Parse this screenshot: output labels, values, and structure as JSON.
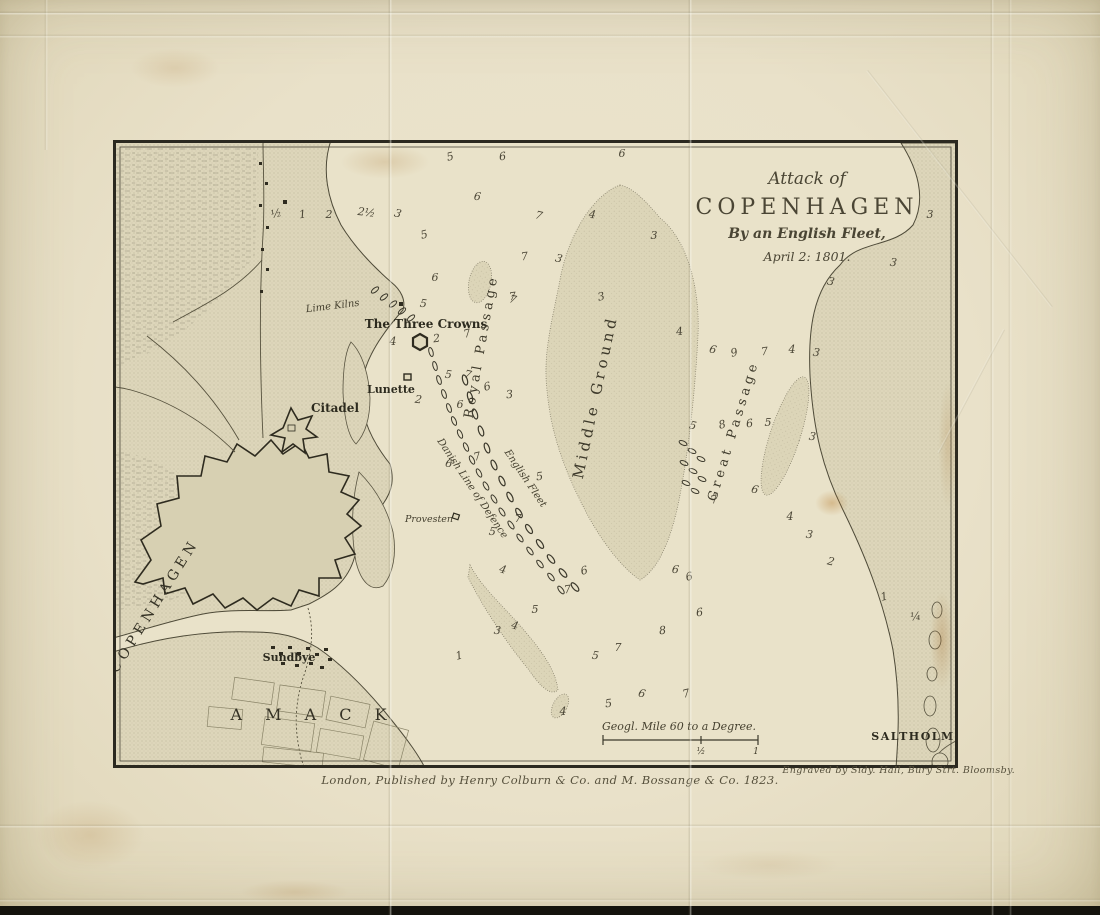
{
  "title": {
    "line1": "Attack of",
    "line2": "COPENHAGEN",
    "line3": "By an English Fleet,",
    "line4": "April 2: 1801."
  },
  "labels": {
    "copenhagen": "COPENHAGEN",
    "citadel": "Citadel",
    "lunette": "Lunette",
    "three_crowns": "The Three Crowns",
    "lime_kilns": "Lime Kilns",
    "sundbye": "Sundbye",
    "amack": "A M A C K",
    "saltholm": "SALTHOLM",
    "middle_ground": "Middle Ground",
    "royal_passage": "Royal Passage",
    "great_passage": "Great Passage",
    "danish_line": "Danish Line of Defence",
    "english_fleet": "English Fleet",
    "provesten": "Provesten"
  },
  "scale": {
    "label": "Geogl. Mile 60 to a Degree.",
    "half": "½",
    "one": "1"
  },
  "imprint": {
    "publisher": "London, Published by Henry Colburn & Co. and M. Bossange & Co. 1823.",
    "engraver": "Engraved by Sidy. Hall, Bury Strt. Bloomsby."
  },
  "colors": {
    "paper": "#e9e1c9",
    "ink": "#3b382b",
    "land": "#ddd6ba",
    "stain": "#b9894a"
  },
  "soundings": [
    [
      164,
      77,
      "½"
    ],
    [
      190,
      78,
      "1"
    ],
    [
      216,
      78,
      "2"
    ],
    [
      253,
      76,
      "2½"
    ],
    [
      284,
      77,
      "3"
    ],
    [
      338,
      20,
      "5"
    ],
    [
      390,
      20,
      "6"
    ],
    [
      509,
      17,
      "6"
    ],
    [
      364,
      60,
      "6"
    ],
    [
      425,
      79,
      "7"
    ],
    [
      312,
      98,
      "5"
    ],
    [
      412,
      120,
      "7"
    ],
    [
      322,
      141,
      "6"
    ],
    [
      479,
      78,
      "4"
    ],
    [
      445,
      122,
      "3"
    ],
    [
      489,
      160,
      "3"
    ],
    [
      400,
      160,
      "7"
    ],
    [
      541,
      99,
      "3"
    ],
    [
      310,
      167,
      "5"
    ],
    [
      399,
      163,
      "7"
    ],
    [
      355,
      197,
      "7"
    ],
    [
      324,
      202,
      "2"
    ],
    [
      280,
      205,
      "4"
    ],
    [
      335,
      238,
      "5"
    ],
    [
      354,
      238,
      "7"
    ],
    [
      375,
      250,
      "6"
    ],
    [
      397,
      258,
      "3"
    ],
    [
      347,
      268,
      "6"
    ],
    [
      305,
      263,
      "2"
    ],
    [
      335,
      327,
      "6"
    ],
    [
      365,
      320,
      "7"
    ],
    [
      427,
      340,
      "5"
    ],
    [
      405,
      382,
      "7"
    ],
    [
      379,
      395,
      "5"
    ],
    [
      389,
      433,
      "4"
    ],
    [
      472,
      434,
      "6"
    ],
    [
      455,
      453,
      "7"
    ],
    [
      422,
      473,
      "5"
    ],
    [
      384,
      494,
      "3"
    ],
    [
      401,
      489,
      "4"
    ],
    [
      347,
      519,
      "1"
    ],
    [
      550,
      494,
      "8"
    ],
    [
      505,
      511,
      "7"
    ],
    [
      482,
      519,
      "5"
    ],
    [
      528,
      557,
      "6"
    ],
    [
      574,
      557,
      "7"
    ],
    [
      496,
      567,
      "5"
    ],
    [
      450,
      575,
      "4"
    ],
    [
      562,
      433,
      "6"
    ],
    [
      599,
      213,
      "6"
    ],
    [
      622,
      216,
      "9"
    ],
    [
      652,
      215,
      "7"
    ],
    [
      679,
      213,
      "4"
    ],
    [
      703,
      216,
      "3"
    ],
    [
      579,
      289,
      "5"
    ],
    [
      610,
      288,
      "8"
    ],
    [
      637,
      287,
      "6"
    ],
    [
      655,
      286,
      "5"
    ],
    [
      699,
      300,
      "3"
    ],
    [
      641,
      353,
      "6"
    ],
    [
      602,
      363,
      "7"
    ],
    [
      567,
      195,
      "4"
    ],
    [
      817,
      78,
      "3"
    ],
    [
      780,
      126,
      "3"
    ],
    [
      717,
      145,
      "3"
    ],
    [
      577,
      440,
      "6"
    ],
    [
      587,
      476,
      "6"
    ],
    [
      677,
      380,
      "4"
    ],
    [
      696,
      398,
      "3"
    ],
    [
      717,
      425,
      "2"
    ],
    [
      772,
      460,
      "1"
    ],
    [
      803,
      480,
      "¼"
    ]
  ],
  "fleets": {
    "danish": [
      [
        318,
        212
      ],
      [
        322,
        226
      ],
      [
        326,
        240
      ],
      [
        331,
        254
      ],
      [
        336,
        268
      ],
      [
        341,
        281
      ],
      [
        347,
        294
      ],
      [
        353,
        307
      ],
      [
        359,
        320
      ],
      [
        366,
        333
      ],
      [
        373,
        346
      ],
      [
        381,
        359
      ],
      [
        389,
        372
      ],
      [
        398,
        385
      ],
      [
        407,
        398
      ],
      [
        417,
        411
      ],
      [
        427,
        424
      ],
      [
        438,
        437
      ],
      [
        448,
        450
      ]
    ],
    "english": [
      [
        352,
        240
      ],
      [
        357,
        257
      ],
      [
        362,
        274
      ],
      [
        368,
        291
      ],
      [
        374,
        308
      ],
      [
        381,
        325
      ],
      [
        389,
        341
      ],
      [
        397,
        357
      ],
      [
        406,
        373
      ],
      [
        416,
        389
      ],
      [
        427,
        404
      ],
      [
        438,
        419
      ],
      [
        450,
        433
      ],
      [
        462,
        447
      ]
    ],
    "reserve": [
      [
        298,
        178
      ],
      [
        289,
        171
      ],
      [
        280,
        164
      ],
      [
        271,
        157
      ],
      [
        262,
        150
      ]
    ],
    "great_passage_group": [
      [
        570,
        303
      ],
      [
        579,
        311
      ],
      [
        588,
        319
      ],
      [
        571,
        323
      ],
      [
        580,
        331
      ],
      [
        589,
        339
      ],
      [
        573,
        343
      ],
      [
        582,
        351
      ]
    ]
  },
  "islets": [
    [
      824,
      470,
      5,
      8
    ],
    [
      822,
      500,
      6,
      9
    ],
    [
      819,
      534,
      5,
      7
    ],
    [
      817,
      566,
      6,
      10
    ],
    [
      820,
      600,
      7,
      12
    ],
    [
      827,
      622,
      8,
      9
    ]
  ]
}
